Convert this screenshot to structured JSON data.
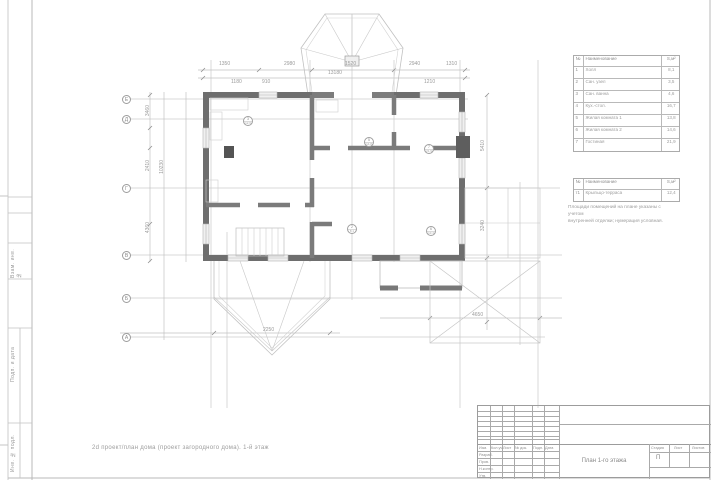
{
  "sheet": {
    "caption": "2d проект/план дома (проект загородного дома). 1-й этаж",
    "stamp_labels": {
      "vzam": "Взам. инв. №",
      "podp": "Подп. и дата",
      "inv": "Инв. № подл."
    }
  },
  "plan": {
    "axes": [
      "Е",
      "Д",
      "Г",
      "В",
      "Б",
      "А"
    ],
    "room_tags": [
      {
        "num": "3",
        "area": "12,6"
      },
      {
        "num": "5",
        "area": "14,8"
      },
      {
        "num": "7",
        "area": "21,9"
      },
      {
        "num": "2",
        "area": "8,1"
      },
      {
        "num": "6",
        "area": "13,4"
      }
    ],
    "dims": [
      "1350",
      "2980",
      "1520",
      "2940",
      "1310",
      "13180",
      "3460",
      "2410",
      "4360",
      "10230",
      "5410",
      "3240",
      "4650",
      "2250",
      "910",
      "1180",
      "1210"
    ]
  },
  "legend": {
    "header": {
      "num": "№",
      "name": "Наименование",
      "area": "S,м²"
    },
    "rows": [
      {
        "num": "1",
        "name": "Холл",
        "area": "8,1"
      },
      {
        "num": "2",
        "name": "Сан. узел",
        "area": "3,5"
      },
      {
        "num": "3",
        "name": "Сан. ванна",
        "area": "4,6"
      },
      {
        "num": "4",
        "name": "Кух.-стол.",
        "area": "16,7"
      },
      {
        "num": "5",
        "name": "Жилая комната 1",
        "area": "13,8"
      },
      {
        "num": "6",
        "name": "Жилая комната 2",
        "area": "14,6"
      },
      {
        "num": "7",
        "name": "Гостиная",
        "area": "21,9"
      }
    ]
  },
  "legend2": {
    "header": {
      "num": "№",
      "name": "Наименование",
      "area": "S,м²"
    },
    "rows": [
      {
        "num": "т1",
        "name": "Крыльцо-терраса",
        "area": "12,4"
      }
    ]
  },
  "note": {
    "line1": "Площади помещений на плане указаны с учетом",
    "line2": "внутренней отделки; нумерация условная."
  },
  "titleblock": {
    "header_cols": [
      "Изм.",
      "Кол.уч.",
      "Лист",
      "№ док.",
      "Подп.",
      "Дата"
    ],
    "roles": [
      "Разраб.",
      "Пров.",
      "Н.контр.",
      "Утв."
    ],
    "stage_label": "Стадия",
    "sheet_label": "Лист",
    "sheets_label": "Листов",
    "stage_value": "П",
    "drawing_title": "План 1-го этажа"
  }
}
